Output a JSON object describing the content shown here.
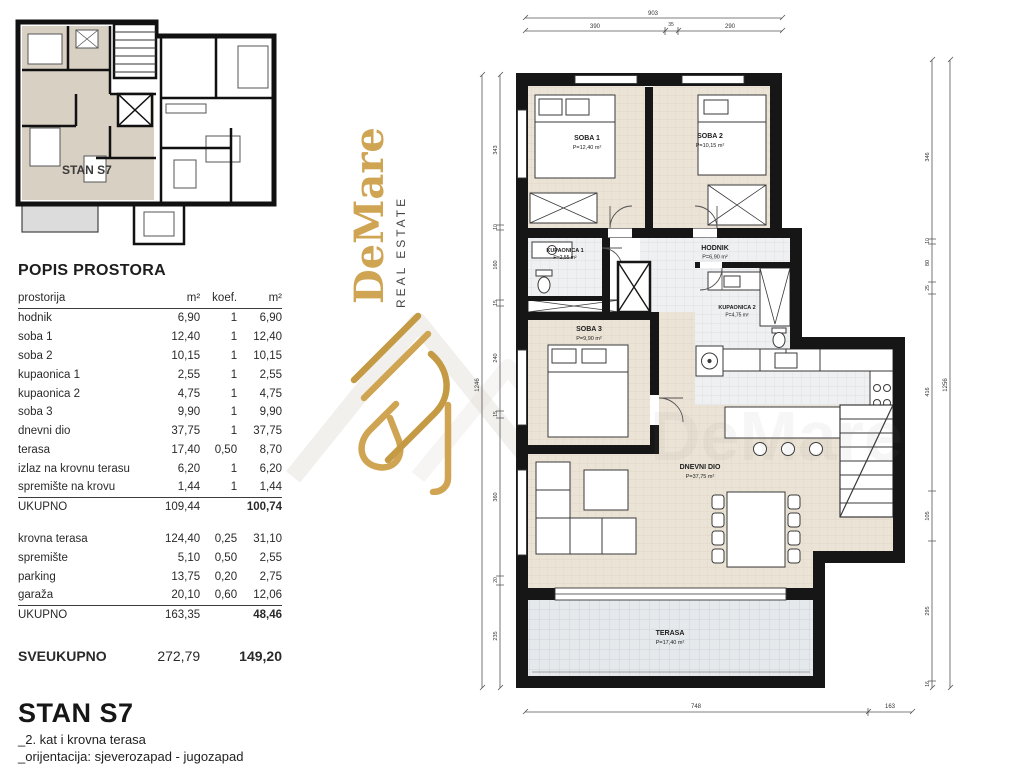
{
  "brand": {
    "name": "DeMare",
    "tagline": "REAL ESTATE",
    "gold": "#cfa452",
    "dark": "#474747"
  },
  "overview_plan": {
    "unit_label": "STAN S7"
  },
  "table": {
    "title": "POPIS PROSTORA",
    "headers": [
      "prostorija",
      "m²",
      "koef.",
      "m²"
    ],
    "groups": [
      {
        "rows": [
          [
            "hodnik",
            "6,90",
            "1",
            "6,90"
          ],
          [
            "soba 1",
            "12,40",
            "1",
            "12,40"
          ],
          [
            "soba 2",
            "10,15",
            "1",
            "10,15"
          ],
          [
            "kupaonica 1",
            "2,55",
            "1",
            "2,55"
          ],
          [
            "kupaonica 2",
            "4,75",
            "1",
            "4,75"
          ],
          [
            "soba 3",
            "9,90",
            "1",
            "9,90"
          ],
          [
            "dnevni dio",
            "37,75",
            "1",
            "37,75"
          ],
          [
            "terasa",
            "17,40",
            "0,50",
            "8,70"
          ],
          [
            "izlaz na krovnu terasu",
            "6,20",
            "1",
            "6,20"
          ],
          [
            "spremište na krovu",
            "1,44",
            "1",
            "1,44"
          ]
        ],
        "subtotal": [
          "UKUPNO",
          "109,44",
          "",
          "100,74"
        ]
      },
      {
        "rows": [
          [
            "krovna terasa",
            "124,40",
            "0,25",
            "31,10"
          ],
          [
            "spremište",
            "5,10",
            "0,50",
            "2,55"
          ],
          [
            "parking",
            "13,75",
            "0,20",
            "2,75"
          ],
          [
            "garaža",
            "20,10",
            "0,60",
            "12,06"
          ]
        ],
        "subtotal": [
          "UKUPNO",
          "163,35",
          "",
          "48,46"
        ]
      }
    ],
    "grand_total": [
      "SVEUKUPNO",
      "272,79",
      "",
      "149,20"
    ]
  },
  "title_block": {
    "title": "STAN S7",
    "subtitle1": "_2. kat i krovna terasa",
    "subtitle2": "_orijentacija: sjeverozapad - jugozapad"
  },
  "floor_plan": {
    "rooms": {
      "soba1": {
        "name": "SOBA 1",
        "area": "P=12,40 m²"
      },
      "soba2": {
        "name": "SOBA 2",
        "area": "P=10,15 m²"
      },
      "kupaonica1": {
        "name": "KUPAONICA 1",
        "area": "P=2,55 m²"
      },
      "hodnik": {
        "name": "HODNIK",
        "area": "P=6,90 m²"
      },
      "kupaonica2": {
        "name": "KUPAONICA 2",
        "area": "P=4,75 m²"
      },
      "soba3": {
        "name": "SOBA 3",
        "area": "P=9,90 m²"
      },
      "dnevni": {
        "name": "DNEVNI DIO",
        "area": "P=37,75 m²"
      },
      "terasa": {
        "name": "TERASA",
        "area": "P=17,40 m²"
      }
    },
    "dims": {
      "top_total": "903",
      "top_seg1": "390",
      "top_seg2": "35",
      "top_seg3": "290",
      "bottom_seg1": "748",
      "bottom_seg2": "163",
      "left_total": "1246",
      "left_segs": [
        "343",
        "10",
        "160",
        "15",
        "240",
        "15",
        "360",
        "20",
        "235"
      ],
      "right_total": "1256",
      "right_segs": [
        "346",
        "10",
        "80",
        "25",
        "416",
        "105",
        "295",
        "16"
      ]
    }
  }
}
